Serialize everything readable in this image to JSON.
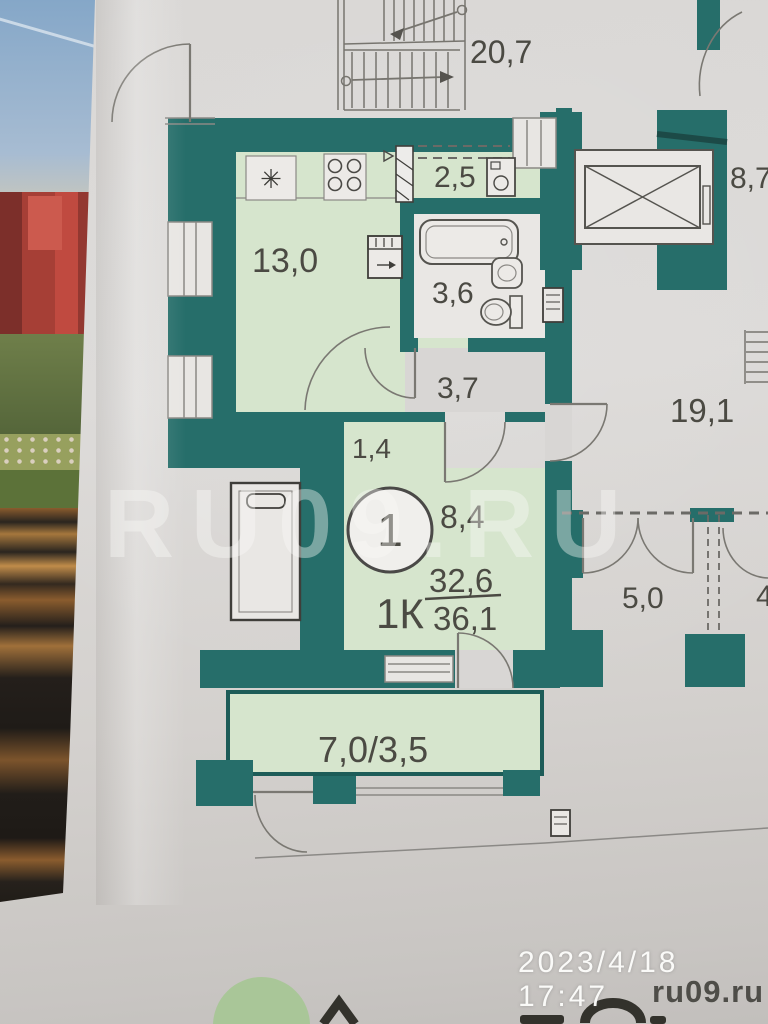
{
  "photo_meta": {
    "timestamp": "2023/4/18 17:47",
    "watermark_site": "ru09.ru",
    "watermark_large": "RU09.RU"
  },
  "apartment": {
    "unit_number": "1",
    "type_label": "1К",
    "area_living": "32,6",
    "area_total": "36,1"
  },
  "areas": {
    "stairwell": "20,7",
    "kitchen_living": "13,0",
    "kitchen_niche": "2,5",
    "bathroom": "3,6",
    "hall": "3,7",
    "wardrobe": "1,4",
    "room": "8,4",
    "elevator_lobby": "8,7",
    "corridor": "19,1",
    "storage": "5,0",
    "balcony": "7,0/3,5",
    "partial_right": "4"
  },
  "colors": {
    "wall": "#266e6a",
    "wall_dark": "#1c4a47",
    "room_fill": "#d6e5cd",
    "fixture_fill": "#eceae7",
    "paper": "#d8d6d4",
    "label": "#4b4a43"
  }
}
